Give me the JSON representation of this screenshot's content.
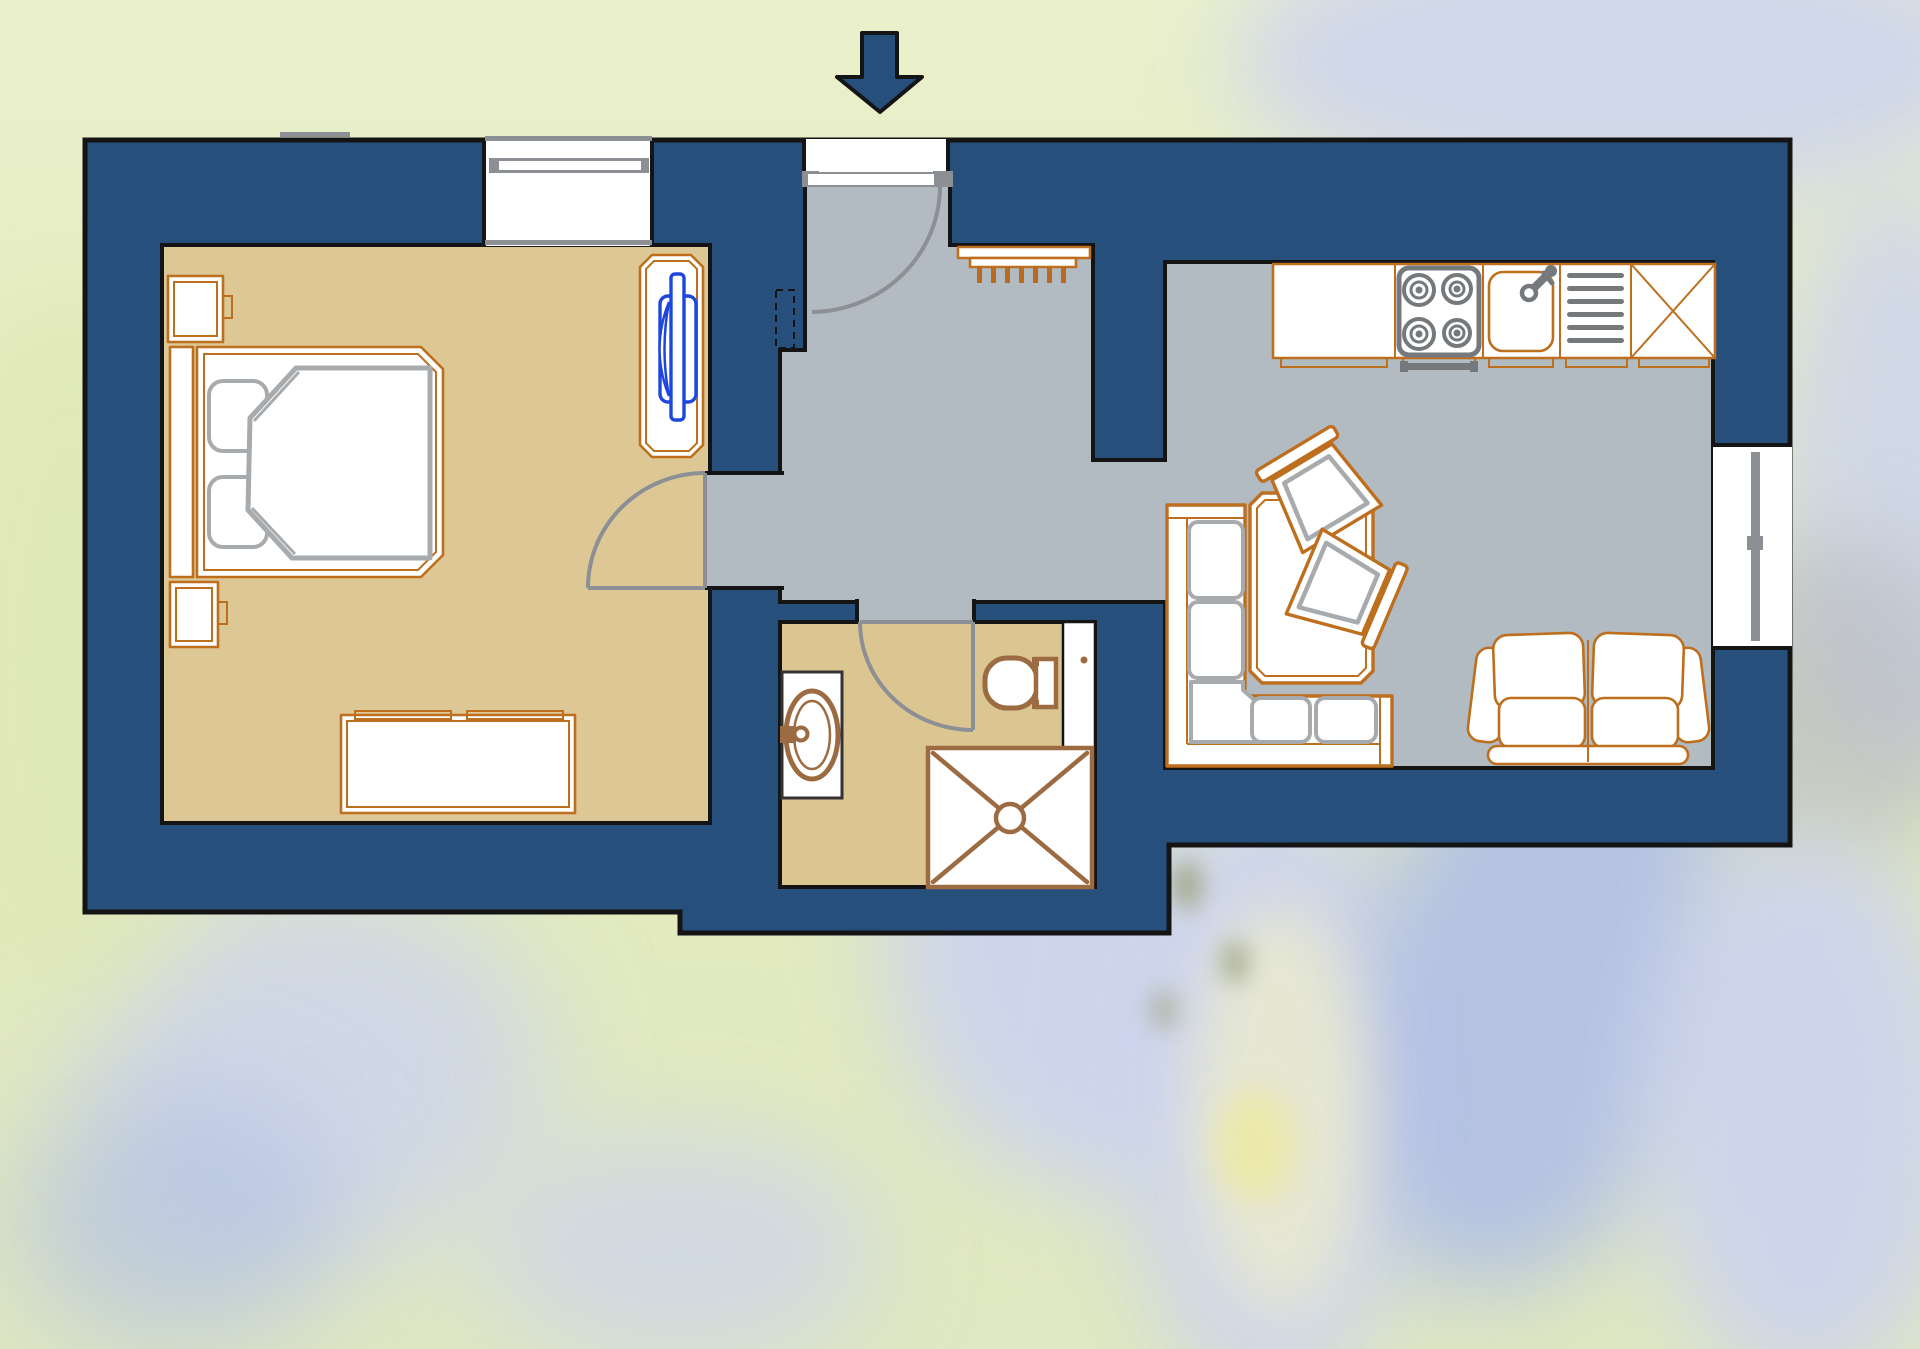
{
  "scene": {
    "type": "apartment-floor-plan",
    "background": "blurred blue gentian flowers on pale yellow-green meadow",
    "visible_text": "none"
  },
  "colors": {
    "wall": "#264f7c",
    "outline": "#141414",
    "floor_bedroom": "#dcc795",
    "floor_hall": "#b2bac2",
    "floor_bathroom": "#dbc590",
    "furniture_outline": "#bd6f1e",
    "prong_orange": "#b96a1e",
    "fixture_brown": "#9c6b42",
    "appliance_gray": "#75797c",
    "cushion_gray": "#a7abae",
    "door_gray": "#8c9094",
    "window_gray": "#8c9094",
    "fixture_blue": "#1e46dd",
    "bg_top": "#eaf0cc",
    "bg_green": "#dfe8b6",
    "bg_petal": "#ccd3ef",
    "bg_petal_deep": "#aebce8",
    "bg_speckle": "#9aa078",
    "bg_anther": "#ece9a8",
    "bg_gray": "#b5b7bc"
  },
  "entrance": {
    "indicator": "down-arrow above entrance door",
    "door": "swings into hallway, hinged left"
  },
  "rooms": [
    {
      "name": "bedroom",
      "floor": "tan",
      "furniture": [
        "double-bed with two pillows and blanket",
        "headboard rail",
        "nightstand top",
        "nightstand bottom",
        "dresser",
        "tv-table with blue fixture"
      ],
      "openings": [
        "window in top wall",
        "door to hallway"
      ]
    },
    {
      "name": "hallway",
      "floor": "gray",
      "furniture": [
        "coat-rack with seven hooks",
        "dashed wall recess"
      ],
      "openings": [
        "entrance door",
        "passage to living area",
        "door to bathroom",
        "door to bedroom"
      ]
    },
    {
      "name": "bathroom",
      "floor": "tan",
      "furniture": [
        "washbasin cabinet",
        "toilet",
        "shower with X tray",
        "wall shelf"
      ],
      "openings": [
        "door to hallway"
      ]
    },
    {
      "name": "kitchen-living-room",
      "floor": "gray",
      "furniture": [
        "kitchen counter",
        "four-burner stove",
        "kitchen sink with faucet",
        "drainer rack",
        "corner cabinet X",
        "corner bench with cushions",
        "dining table",
        "dining chair upper",
        "dining chair right",
        "loveseat"
      ],
      "openings": [
        "window in right wall"
      ]
    }
  ]
}
